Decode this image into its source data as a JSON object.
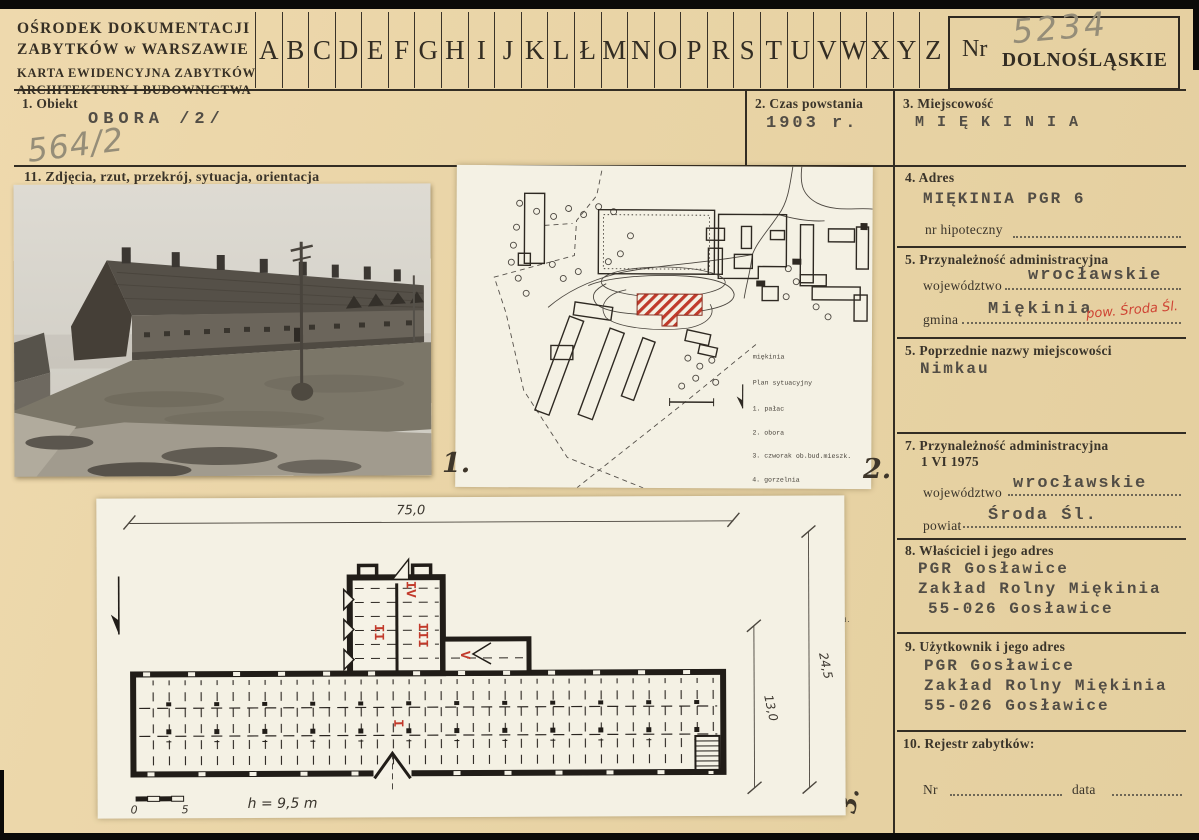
{
  "header": {
    "org_line1": "OŚRODEK DOKUMENTACJI",
    "org_line2": "ZABYTKÓW w WARSZAWIE",
    "karta_line1": "KARTA EWIDENCYJNA ZABYTKÓW",
    "karta_line2": "ARCHITEKTURY I BUDOWNICTWA",
    "alphabet": [
      "A",
      "B",
      "C",
      "D",
      "E",
      "F",
      "G",
      "H",
      "I",
      "J",
      "K",
      "L",
      "Ł",
      "M",
      "N",
      "O",
      "P",
      "R",
      "S",
      "T",
      "U",
      "V",
      "W",
      "X",
      "Y",
      "Z"
    ],
    "nr_label": "Nr",
    "nr_value": "5234",
    "region_stamp": "DOLNOŚLĄSKIE"
  },
  "archive_no": "564/2",
  "fields": {
    "obiekt": {
      "label": "1. Obiekt",
      "value": "OBORA /2/"
    },
    "czas": {
      "label": "2. Czas powstania",
      "value": "1903 r."
    },
    "miejscowosc": {
      "label": "3. Miejscowość",
      "value": "M I Ę K I N I A"
    },
    "adres": {
      "label": "4. Adres",
      "value": "MIĘKINIA PGR 6",
      "hipoteczny_label": "nr  hipoteczny"
    },
    "przynaleznosc": {
      "label": "5. Przynależność administracyjna",
      "woj_label": "województwo",
      "woj_value": "wrocławskie",
      "gmina_label": "gmina",
      "gmina_value": "Miękinia",
      "gmina_annotation": "pow. Środa Śl."
    },
    "poprzednie": {
      "label": "5. Poprzednie nazwy miejscowości",
      "value": "Nimkau"
    },
    "przynaleznosc1975": {
      "label": "7. Przynależność administracyjna",
      "sublabel": "1 VI 1975",
      "woj_label": "województwo",
      "woj_value": "wrocławskie",
      "powiat_label": "powiat",
      "powiat_value": "Środa Śl."
    },
    "wlasciciel": {
      "label": "8. Właściciel i jego adres",
      "lines": [
        "PGR Gosławice",
        "Zakład Rolny Miękinia",
        "55-026 Gosławice"
      ]
    },
    "uzytkownik": {
      "label": "9. Użytkownik i jego adres",
      "lines": [
        "PGR Gosławice",
        "Zakład Rolny Miękinia",
        "55-026 Gosławice"
      ]
    },
    "rejestr": {
      "label": "10. Rejestr zabytków:",
      "nr_label": "Nr",
      "data_label": "data"
    }
  },
  "media": {
    "section_label": "11. Zdjęcia, rzut, przekrój, sytuacja, orientacja",
    "photo_caption": "1.",
    "siteplan_caption": "2.",
    "floorplan_caption": "3.",
    "siteplan": {
      "title1": "miękinia",
      "title2": "Plan sytuacyjny",
      "legend": [
        "1. pałac",
        "2. obora",
        "3. czworak ob.bud.mieszk.",
        "4. gorzelnia",
        "5. chlewnia",
        "6. spichlerz",
        "7. stodoła",
        "8. bud. gospodarczy",
        "9. obora",
        "10. dom zarządcy ob. bud.",
        "    mieszk.",
        "11. stodoła",
        "12. stodoła",
        "13. budynki nowe w obrę-",
        "    bie zespołu folw.",
        "14. bud. poza zespołem",
        "    folw."
      ]
    },
    "floorplan": {
      "dim_length": "75,0",
      "dim_width": "24,5",
      "dim_inner": "13,0",
      "height_note": "h = 9,5 m",
      "scale_start": "0",
      "scale_end": "5",
      "rooms": [
        "I",
        "II",
        "III",
        "IV",
        "V"
      ]
    }
  }
}
